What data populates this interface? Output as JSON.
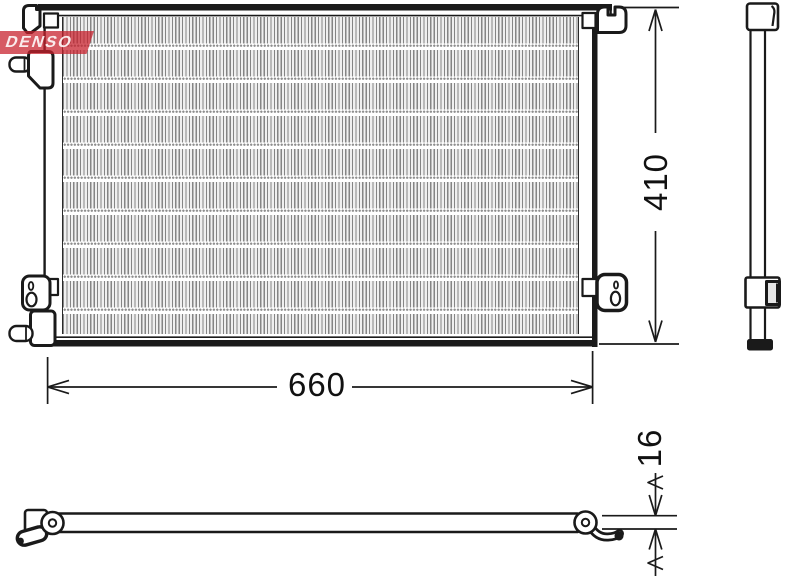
{
  "brand": {
    "logo_text": "DENSO",
    "red": "#c8202c"
  },
  "front_view": {
    "width_label": "660",
    "height_label": "410"
  },
  "top_view": {
    "thickness_label": "16"
  },
  "colors": {
    "line": "#1a1a1a",
    "mesh_gray": "#858585",
    "background": "#ffffff"
  }
}
